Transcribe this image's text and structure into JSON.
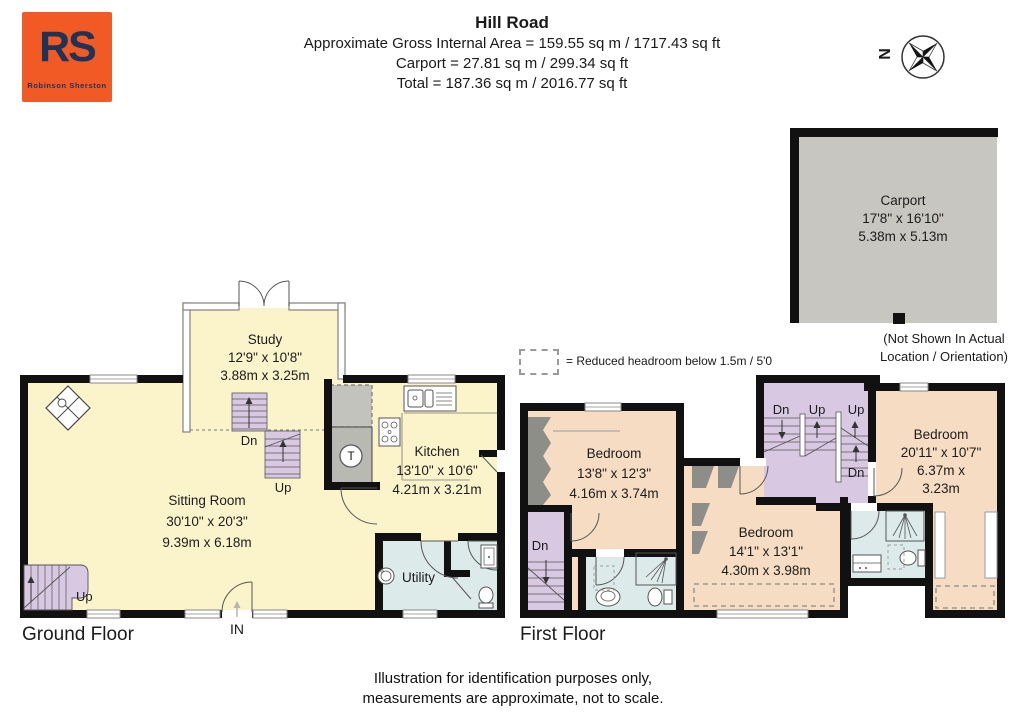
{
  "header": {
    "logo": {
      "initials": "RS",
      "name": "Robinson Sherston"
    },
    "title": "Hill Road",
    "line1": "Approximate Gross Internal Area = 159.55 sq m / 1717.43 sq ft",
    "line2": "Carport = 27.81 sq m / 299.34 sq ft",
    "line3": "Total = 187.36 sq m / 2016.77 sq ft",
    "compass": "N"
  },
  "carport": {
    "name": "Carport",
    "imperial": "17'8\" x 16'10\"",
    "metric": "5.38m x 5.13m",
    "note1": "(Not Shown In Actual",
    "note2": "Location / Orientation)"
  },
  "legend": {
    "text": "= Reduced headroom below 1.5m / 5'0"
  },
  "ground_floor": {
    "label": "Ground Floor",
    "entrance": "IN",
    "tank": "T",
    "study": {
      "name": "Study",
      "imperial": "12'9\" x 10'8\"",
      "metric": "3.88m x 3.25m"
    },
    "sitting_room": {
      "name": "Sitting Room",
      "imperial": "30'10\" x 20'3\"",
      "metric": "9.39m x 6.18m"
    },
    "kitchen": {
      "name": "Kitchen",
      "imperial": "13'10\" x 10'6\"",
      "metric": "4.21m x 3.21m"
    },
    "utility": {
      "name": "Utility"
    },
    "stairs": {
      "dn": "Dn",
      "up": "Up",
      "up_left": "Up"
    }
  },
  "first_floor": {
    "label": "First Floor",
    "bedroom1": {
      "name": "Bedroom",
      "imperial": "13'8\" x 12'3\"",
      "metric": "4.16m x 3.74m"
    },
    "bedroom2": {
      "name": "Bedroom",
      "imperial": "14'1\" x 13'1\"",
      "metric": "4.30m x 3.98m"
    },
    "bedroom3": {
      "name": "Bedroom",
      "imperial": "20'11\" x 10'7\"",
      "metric": "6.37m x 3.23m"
    },
    "stairs": {
      "dn1": "Dn",
      "up1": "Up",
      "up2": "Up",
      "dn2": "Dn",
      "dn_left": "Dn"
    }
  },
  "footer": {
    "line1": "Illustration for identification purposes only,",
    "line2": "measurements are approximate, not to scale."
  },
  "colors": {
    "logo_orange": "#F15A24",
    "logo_navy": "#1F3357",
    "floor_yellow": "#FBF4CB",
    "bedroom_peach": "#F6DCC2",
    "stairs_lilac": "#D9C8E2",
    "bath_blue": "#DCEBEA",
    "carport_gray": "#C7C6C1",
    "eaves_gray": "#8E8E88",
    "wall_black": "#111111"
  }
}
